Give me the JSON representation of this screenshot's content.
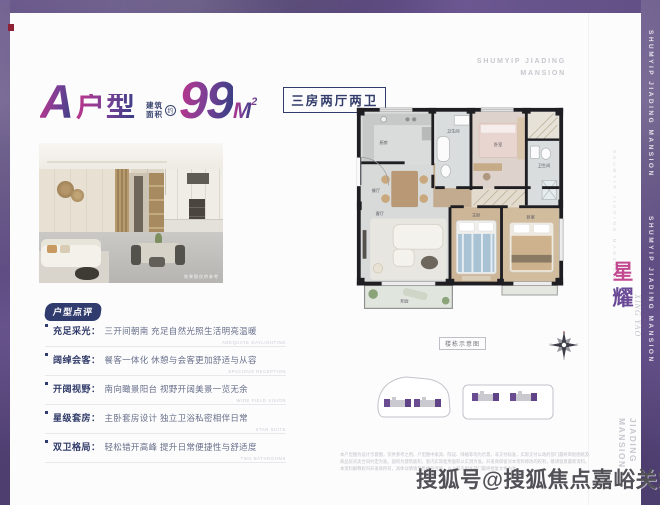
{
  "header": {
    "unit_letter": "A",
    "unit_word": "户型",
    "area_prefix_line1": "建筑",
    "area_prefix_line2": "面积",
    "area_approx": "约",
    "area_value": "99",
    "area_unit": "M",
    "area_exp": "2",
    "layout_tag": "三房两厅两卫"
  },
  "brand": {
    "top_right_line1": "SHUMYIP JIADING",
    "top_right_line2": "MANSION",
    "side_dotted": "SHUMYIP JIADING MANSION",
    "name_cn_1": "星",
    "name_cn_2": "耀",
    "name_en": "XING YAO",
    "side_bottom_line1": "SHUMYIP JIADING",
    "side_bottom_line2": "MANSION",
    "border_text_1": "SHUMYIP JIADING MANSION",
    "border_text_2": "SHUMYIP JIADING MANSION"
  },
  "photo": {
    "caption": "效果图仅供参考"
  },
  "review": {
    "badge": "户型点评",
    "items": [
      {
        "label": "充足采光：",
        "text": "三开间朝南 充足自然光照生活明亮温暖",
        "note": "ADEQUATE DAYLIGHTING"
      },
      {
        "label": "阔绰会客：",
        "text": "餐客一体化 休憩与会客更加舒适与从容",
        "note": "SPACIOUS RECEPTION"
      },
      {
        "label": "开阔视野：",
        "text": "南向瞰景阳台 视野开阔美景一览无余",
        "note": "WIDE FIELD VISION"
      },
      {
        "label": "星级套房：",
        "text": "主卧套房设计 独立卫浴私密相伴日常",
        "note": "STAR SUITE"
      },
      {
        "label": "双卫格局：",
        "text": "轻松错开高峰 提升日常便捷性与舒适度",
        "note": "TWO BATHROOMS"
      }
    ]
  },
  "plan": {
    "caption": "楼栋示意图",
    "rooms": {
      "kitchen": "厨房",
      "dining": "餐厅",
      "living": "客厅",
      "balcony": "阳台",
      "master": "主卧",
      "bedroom2": "卧室",
      "bedroom3": "卧室",
      "bath1": "卫生间",
      "bath2": "卫生间"
    }
  },
  "compass": {
    "n": "N",
    "e": "E",
    "s": "S",
    "w": "W"
  },
  "disclaimer": {
    "line1": "本户型图为设计示意图，仅供参考之用。户型图中家具、陈设、绿植等均为示意，非交付标准，实际交付以政府部门最终审批图纸及",
    "line2": "商品房买卖合同约定为准。面积为建筑面积，套内实际使用面积以实测为准。开发商保留对本资料修改的权利，敬请留意最新资料。",
    "line3": "本资料解释权归开发商所有，具体详情请至售楼处咨询，以上海市相关部门最终批复文件为准。"
  },
  "watermark": {
    "text": "搜狐号@搜狐焦点嘉峪关站"
  },
  "colors": {
    "accent_gradient_start": "#b8368c",
    "accent_gradient_end": "#3c3f85",
    "navy": "#2f3a68",
    "border_purple": "#5a4a7a",
    "site_purple": "#6a4c92"
  }
}
